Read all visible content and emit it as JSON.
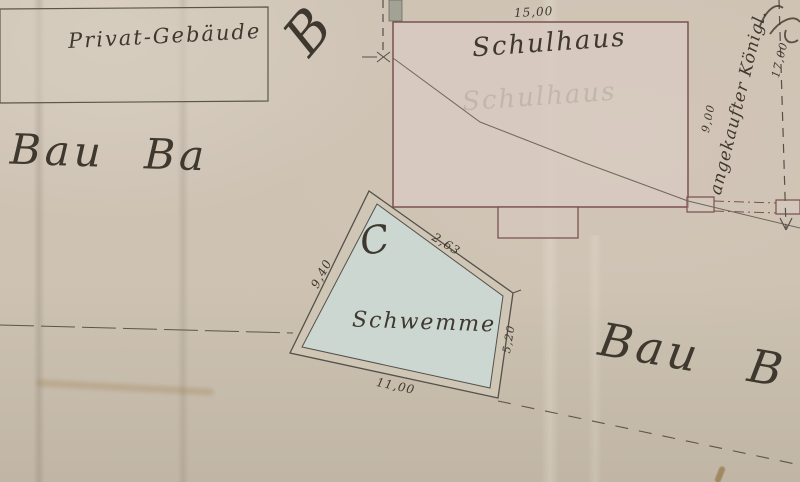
{
  "plan": {
    "title": "historical site plan (hand-drawn, Kurrent script)",
    "labels": {
      "private_building": "Privat-Gebäude",
      "school": "Schulhaus",
      "basin_letter": "C",
      "basin": "Schwemme"
    },
    "measurements": {
      "school_width": "15,00",
      "basin_left": "9,40",
      "basin_diagonal": "2,63",
      "basin_right": "5,20",
      "basin_bottom": "11,00",
      "annex_depth": "9,00",
      "boundary_offset": "17,00"
    },
    "annotations": {
      "vertical_note": "angekaufter Königl.",
      "street_left": "Bau Ba",
      "street_right": "Bau B",
      "top_fragment": "B"
    },
    "colors": {
      "paper": "#cdc3b3",
      "building_outline_red": "#7b5150",
      "building_fill_pink": "#d8cac1",
      "basin_fill_blue": "#ccd7d2",
      "ink": "#3f382e",
      "pencil": "#6f675c",
      "survey_line": "#55504a"
    }
  }
}
